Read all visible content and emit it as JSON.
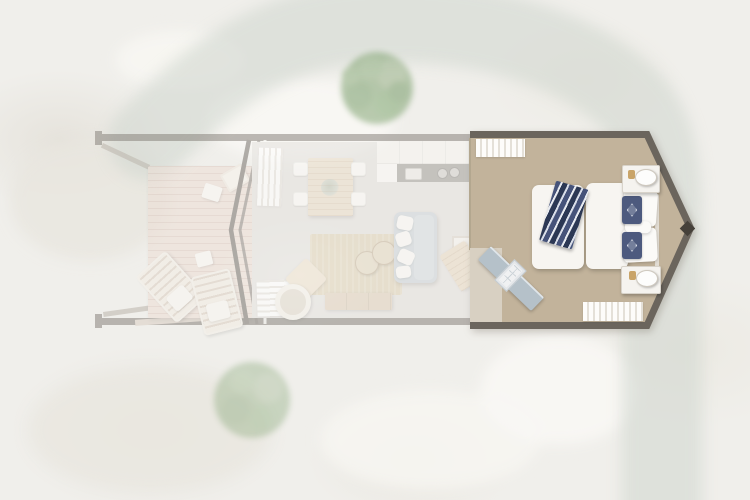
{
  "meta": {
    "view": "top-down-floor-plan-render",
    "highlighted_room": "bedroom"
  },
  "palette": {
    "terrain_base": "#f0efeb",
    "trail": "#d2d8d0",
    "tree_mid": "#7da06d",
    "tree_dark": "#6e9660",
    "tree_light": "#92ad81",
    "wall_dark": "#6b655d",
    "wall_faded": "#837e77",
    "deck_wood": "#ecddd4",
    "living_floor": "#e3e0dd",
    "bedroom_floor": "#c2b39b",
    "rug": "#dccfb3",
    "sofa": "#c9d2d8",
    "wood_light": "#e8dac5",
    "wood_mid": "#dfceb8",
    "counter_gray": "#9b9995",
    "navy": "#4d5a7e",
    "door_blue": "#b5c1c9",
    "lamp_gold": "#c9a469",
    "white_fabric": "#f7f5f1"
  },
  "environment": {
    "trail": {
      "present": true,
      "route": "enters-top-curves-right-descends-past-cabin-to-bottom"
    },
    "trees": [
      {
        "id": "tree-north",
        "faded": true
      },
      {
        "id": "tree-south",
        "faded": true
      }
    ]
  },
  "floorplan": {
    "orientation": "horizontal-elongated-cabin-with-pointed-east-end",
    "rooms": [
      {
        "id": "deck",
        "highlighted": false,
        "furniture": [
          {
            "name": "lounge-chair"
          },
          {
            "name": "lounge-chair"
          },
          {
            "name": "deck-chair"
          },
          {
            "name": "scatter-cushion"
          },
          {
            "name": "scatter-cushion"
          }
        ]
      },
      {
        "id": "living-kitchen",
        "highlighted": false,
        "furniture": [
          {
            "name": "dining-table"
          },
          {
            "name": "dining-chair",
            "count": 4
          },
          {
            "name": "kitchen-cabinets"
          },
          {
            "name": "countertop-with-sink-and-cooktop"
          },
          {
            "name": "sofa"
          },
          {
            "name": "rug"
          },
          {
            "name": "pouf",
            "count": 2
          },
          {
            "name": "side-table"
          },
          {
            "name": "tv-console"
          },
          {
            "name": "hanging-ring-chair"
          },
          {
            "name": "armchair"
          },
          {
            "name": "wardrobe"
          },
          {
            "name": "curtains",
            "count": 2
          }
        ]
      },
      {
        "id": "bedroom",
        "highlighted": true,
        "furniture": [
          {
            "name": "double-bed"
          },
          {
            "name": "pillow",
            "count": 2
          },
          {
            "name": "accent-pillow",
            "count": 2
          },
          {
            "name": "throw-blanket"
          },
          {
            "name": "nightstand",
            "count": 2
          },
          {
            "name": "table-lamp",
            "count": 2
          },
          {
            "name": "angled-door-partition"
          },
          {
            "name": "curtains",
            "count": 2
          }
        ]
      }
    ]
  }
}
